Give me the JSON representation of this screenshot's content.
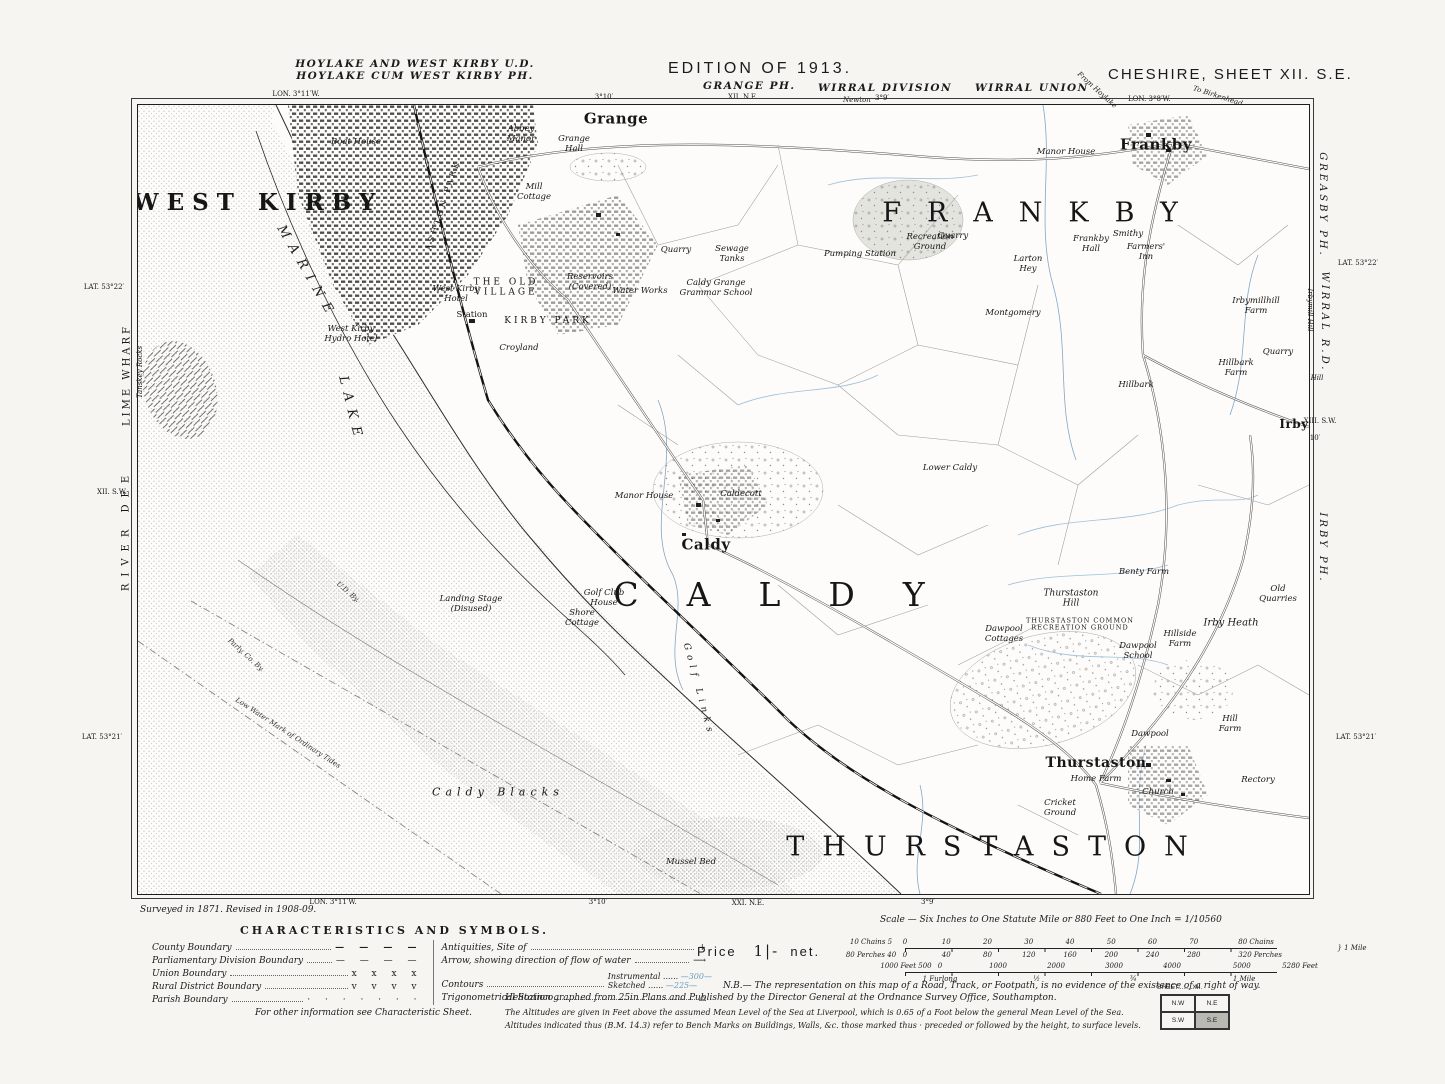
{
  "header": {
    "district_line1": "HOYLAKE AND WEST KIRBY U.D.",
    "district_line2": "HOYLAKE CUM WEST KIRBY PH.",
    "lon_left": "LON. 3°11′W.",
    "edition": "EDITION OF 1913.",
    "parish": "GRANGE PH.",
    "parish_sheet": "XII. N.E.",
    "division": "WIRRAL DIVISION",
    "division_sub": "Newton",
    "union": "WIRRAL UNION",
    "sheet_title": "CHESHIRE, SHEET XII. S.E.",
    "lon_right": "LON. 3°8′W.",
    "to_birkenhead": "To Birkenhead"
  },
  "margins": {
    "labels": [
      {
        "t": "LON. 3°11′W.",
        "x": 296,
        "y": 94,
        "cls": "mtiny"
      },
      {
        "t": "3°10′",
        "x": 604,
        "y": 97,
        "cls": "mtiny"
      },
      {
        "t": "3°9′",
        "x": 882,
        "y": 98,
        "cls": "mtiny"
      },
      {
        "t": "From Hoylake",
        "x": 1097,
        "y": 90,
        "cls": "mtiny-it",
        "rot": 42
      },
      {
        "t": "LAT. 53°22′",
        "x": 104,
        "y": 287,
        "cls": "mtiny"
      },
      {
        "t": "LIME WHARF",
        "x": 127,
        "y": 375,
        "cls": "mvert",
        "rot": -90
      },
      {
        "t": "Tanskey Rocks",
        "x": 140,
        "y": 372,
        "cls": "mtiny-it",
        "rot": -90
      },
      {
        "t": "RIVER DEE",
        "x": 126,
        "y": 530,
        "cls": "mvert",
        "rot": -90,
        "ls": 7
      },
      {
        "t": "XII. S.W.",
        "x": 112,
        "y": 492,
        "cls": "mtiny"
      },
      {
        "t": "LAT. 53°21′",
        "x": 102,
        "y": 737,
        "cls": "mtiny"
      },
      {
        "t": "GREASBY PH.",
        "x": 1322,
        "y": 205,
        "cls": "mvert-it",
        "rot": 90
      },
      {
        "t": "LAT. 53°22′",
        "x": 1358,
        "y": 263,
        "cls": "mtiny"
      },
      {
        "t": "Irbymill Hill",
        "x": 1310,
        "y": 310,
        "cls": "mtiny-it",
        "rot": 90
      },
      {
        "t": "WIRRAL R.D.",
        "x": 1324,
        "y": 322,
        "cls": "mvert-it",
        "rot": 90
      },
      {
        "t": "Hill",
        "x": 1317,
        "y": 378,
        "cls": "mtiny-it"
      },
      {
        "t": "XIII. S.W.",
        "x": 1320,
        "y": 421,
        "cls": "mtiny"
      },
      {
        "t": "10′",
        "x": 1315,
        "y": 438,
        "cls": "mtiny"
      },
      {
        "t": "IRBY PH.",
        "x": 1322,
        "y": 548,
        "cls": "mvert-it",
        "rot": 90
      },
      {
        "t": "LAT. 53°21′",
        "x": 1356,
        "y": 737,
        "cls": "mtiny"
      },
      {
        "t": "LON. 3°11′W.",
        "x": 333,
        "y": 902,
        "cls": "mtiny"
      },
      {
        "t": "3°10′",
        "x": 598,
        "y": 902,
        "cls": "mtiny"
      },
      {
        "t": "XXI. N.E.",
        "x": 748,
        "y": 903,
        "cls": "mtiny"
      },
      {
        "t": "3°9′",
        "x": 928,
        "y": 902,
        "cls": "mtiny"
      }
    ]
  },
  "map": {
    "labels": [
      {
        "t": "WEST KIRBY",
        "x": 120,
        "y": 98,
        "cls": "name-town"
      },
      {
        "t": "MARINE",
        "x": 168,
        "y": 168,
        "cls": "sea-med",
        "rot": 60,
        "ls": 8
      },
      {
        "t": "LAKE",
        "x": 212,
        "y": 305,
        "cls": "sea-med",
        "rot": 76,
        "ls": 8
      },
      {
        "t": "FRANKBY",
        "x": 905,
        "y": 108,
        "cls": "big",
        "fs": 27,
        "ls": 26
      },
      {
        "t": "Frankby",
        "x": 1018,
        "y": 40,
        "cls": "village"
      },
      {
        "t": "Grange",
        "x": 478,
        "y": 14,
        "cls": "village"
      },
      {
        "t": "Caldy",
        "x": 568,
        "y": 440,
        "cls": "village"
      },
      {
        "t": "CALDY",
        "x": 655,
        "y": 490,
        "cls": "big",
        "fs": 33,
        "ls": 48
      },
      {
        "t": "THURSTASTON",
        "x": 858,
        "y": 742,
        "cls": "big",
        "fs": 27,
        "ls": 18
      },
      {
        "t": "Thurstaston",
        "x": 958,
        "y": 658,
        "cls": "village",
        "fs": 14
      },
      {
        "t": "Irby",
        "x": 1156,
        "y": 320,
        "cls": "village",
        "fs": 12
      },
      {
        "t": "THE OLD\nVILLAGE",
        "x": 368,
        "y": 183,
        "cls": "subcaps"
      },
      {
        "t": "KIRBY PARK",
        "x": 410,
        "y": 216,
        "cls": "subcaps"
      },
      {
        "t": "ASHTON PARK",
        "x": 305,
        "y": 100,
        "cls": "subcaps",
        "rot": -72,
        "fs": 8
      },
      {
        "t": "Boat House",
        "x": 218,
        "y": 38,
        "cls": "sm"
      },
      {
        "t": "Abbey\nManor",
        "x": 383,
        "y": 30,
        "cls": "sm"
      },
      {
        "t": "Grange\nHall",
        "x": 436,
        "y": 40,
        "cls": "sm"
      },
      {
        "t": "Mill\nCottage",
        "x": 396,
        "y": 88,
        "cls": "sm"
      },
      {
        "t": "West Kirby\nHotel",
        "x": 318,
        "y": 190,
        "cls": "sm"
      },
      {
        "t": "Station",
        "x": 334,
        "y": 211,
        "cls": "smu"
      },
      {
        "t": "Reservoirs\n(Covered)",
        "x": 452,
        "y": 178,
        "cls": "sm"
      },
      {
        "t": "Water Works",
        "x": 502,
        "y": 187,
        "cls": "sm"
      },
      {
        "t": "Sewage\nTanks",
        "x": 594,
        "y": 150,
        "cls": "sm"
      },
      {
        "t": "Caldy Grange\nGrammar School",
        "x": 578,
        "y": 184,
        "cls": "sm"
      },
      {
        "t": "Quarry",
        "x": 538,
        "y": 146,
        "cls": "sm"
      },
      {
        "t": "Pumping Station",
        "x": 722,
        "y": 150,
        "cls": "sm"
      },
      {
        "t": "Recreation\nGround",
        "x": 792,
        "y": 138,
        "cls": "sm"
      },
      {
        "t": "Quarry",
        "x": 815,
        "y": 132,
        "cls": "sm"
      },
      {
        "t": "Manor House",
        "x": 928,
        "y": 48,
        "cls": "sm"
      },
      {
        "t": "Frankby\nHall",
        "x": 953,
        "y": 140,
        "cls": "sm"
      },
      {
        "t": "Smithy",
        "x": 990,
        "y": 130,
        "cls": "sm"
      },
      {
        "t": "Farmers'\nInn",
        "x": 1008,
        "y": 148,
        "cls": "sm"
      },
      {
        "t": "Larton\nHey",
        "x": 890,
        "y": 160,
        "cls": "sm"
      },
      {
        "t": "Montgomery",
        "x": 875,
        "y": 209,
        "cls": "sm"
      },
      {
        "t": "Hillbark",
        "x": 998,
        "y": 281,
        "cls": "sm"
      },
      {
        "t": "Hillbark\nFarm",
        "x": 1098,
        "y": 264,
        "cls": "sm"
      },
      {
        "t": "Irbymillhill\nFarm",
        "x": 1118,
        "y": 202,
        "cls": "sm"
      },
      {
        "t": "Quarry",
        "x": 1140,
        "y": 248,
        "cls": "sm"
      },
      {
        "t": "Lower Caldy",
        "x": 812,
        "y": 364,
        "cls": "sm"
      },
      {
        "t": "Manor House",
        "x": 506,
        "y": 392,
        "cls": "sm"
      },
      {
        "t": "Caldecott",
        "x": 603,
        "y": 390,
        "cls": "sm"
      },
      {
        "t": "Golf Club\nHouse",
        "x": 466,
        "y": 494,
        "cls": "sm"
      },
      {
        "t": "Shore\nCottage",
        "x": 444,
        "y": 514,
        "cls": "sm"
      },
      {
        "t": "Landing Stage\n(Disused)",
        "x": 333,
        "y": 500,
        "cls": "sm"
      },
      {
        "t": "Golf Links",
        "x": 560,
        "y": 585,
        "cls": "sm",
        "rot": 75,
        "ls": 5,
        "fs": 9
      },
      {
        "t": "Caldy Blacks",
        "x": 360,
        "y": 688,
        "cls": "sea-name"
      },
      {
        "t": "Mussel Bed",
        "x": 553,
        "y": 758,
        "cls": "sm"
      },
      {
        "t": "U.D. By.",
        "x": 210,
        "y": 487,
        "cls": "tinylbl",
        "rot": 40
      },
      {
        "t": "Parly. Co. By.",
        "x": 108,
        "y": 550,
        "cls": "tinylbl",
        "rot": 42
      },
      {
        "t": "Low Water Mark of Ordinary Tides",
        "x": 150,
        "y": 628,
        "cls": "tinylbl",
        "rot": 33
      },
      {
        "t": "West Kirby\nHydro Hotel",
        "x": 213,
        "y": 230,
        "cls": "sm"
      },
      {
        "t": "Croyland",
        "x": 381,
        "y": 244,
        "cls": "sm"
      },
      {
        "t": "Thurstaston\nHill",
        "x": 933,
        "y": 494,
        "cls": "sm",
        "fs": 9
      },
      {
        "t": "THURSTASTON COMMON\nRECREATION GROUND",
        "x": 942,
        "y": 520,
        "cls": "tinycaps"
      },
      {
        "t": "Benty Farm",
        "x": 1006,
        "y": 468,
        "cls": "sm"
      },
      {
        "t": "Irby Heath",
        "x": 1093,
        "y": 518,
        "cls": "sm",
        "fs": 10
      },
      {
        "t": "Old\nQuarries",
        "x": 1140,
        "y": 490,
        "cls": "sm"
      },
      {
        "t": "Dawpool\nCottages",
        "x": 866,
        "y": 530,
        "cls": "sm"
      },
      {
        "t": "Dawpool\nSchool",
        "x": 1000,
        "y": 547,
        "cls": "sm"
      },
      {
        "t": "Hillside\nFarm",
        "x": 1042,
        "y": 535,
        "cls": "sm"
      },
      {
        "t": "Dawpool",
        "x": 1012,
        "y": 630,
        "cls": "sm"
      },
      {
        "t": "Hill\nFarm",
        "x": 1092,
        "y": 620,
        "cls": "sm"
      },
      {
        "t": "Home Farm",
        "x": 958,
        "y": 675,
        "cls": "sm"
      },
      {
        "t": "Cricket\nGround",
        "x": 922,
        "y": 704,
        "cls": "sm"
      },
      {
        "t": "Church",
        "x": 1020,
        "y": 688,
        "cls": "sm"
      },
      {
        "t": "Rectory",
        "x": 1120,
        "y": 676,
        "cls": "sm"
      }
    ]
  },
  "footer": {
    "survey_note": "Surveyed in 1871.   Revised in 1908-09.",
    "characteristics_title": "CHARACTERISTICS AND SYMBOLS.",
    "characteristics_foot": "For other information see Characteristic Sheet.",
    "legend_left": [
      {
        "label": "County Boundary",
        "sym": "— — — —",
        "bold": true
      },
      {
        "label": "Parliamentary Division Boundary",
        "sym": "— — — —"
      },
      {
        "label": "Union Boundary",
        "sym": "x  x  x  x"
      },
      {
        "label": "Rural District Boundary",
        "sym": "v  v  v  v"
      },
      {
        "label": "Parish Boundary",
        "sym": "· · · · · · ·"
      }
    ],
    "legend_right": [
      {
        "label": "Antiquities, Site of",
        "sym": "+"
      },
      {
        "label": "Arrow, showing direction of flow of water",
        "sym": "⟶"
      },
      {
        "label": "Contours",
        "items": [
          {
            "n": "Instrumental",
            "v": "300"
          },
          {
            "n": "Sketched",
            "v": "225"
          }
        ]
      },
      {
        "label": "Trigonometrical Station",
        "sym": "△"
      }
    ],
    "price_label": "Price",
    "price_value": "1|-",
    "price_net": "net.",
    "scale_title": "Scale — Six Inches to One Statute Mile or 880 Feet to One Inch = 1/10560",
    "chains": {
      "caption": "10 Chains 5",
      "ticks": [
        "0",
        "10",
        "20",
        "30",
        "40",
        "50",
        "60",
        "70"
      ],
      "end": "80 Chains"
    },
    "perches": {
      "caption": "80 Perches 40",
      "ticks": [
        "0",
        "40",
        "80",
        "120",
        "160",
        "200",
        "240",
        "280"
      ],
      "end": "320 Perches"
    },
    "mile_brace": "1 Mile",
    "feet": {
      "caption": "1000 Feet  500",
      "ticks": [
        "0",
        "1000",
        "2000",
        "3000",
        "4000"
      ],
      "end": "5000",
      "total": "5280 Feet"
    },
    "furlongs": {
      "ticks": [
        "1 Furlong",
        "½",
        "¾"
      ],
      "end": "1 Mile"
    },
    "nb_note": "N.B.— The representation on this map of a Road, Track, or Footpath, is no evidence of the existence of a right of way.",
    "helio_note": "Heliozincographed from 25in Plans and Published by the Director General at the Ordnance Survey Office, Southampton.",
    "alt_note1": "The Altitudes are given in Feet above the assumed Mean Level of the Sea at Liverpool, which is 0.65 of a Foot below the general Mean Level of the Sea.",
    "alt_note2": "Altitudes indicated thus (B.M. 14.3) refer to Bench Marks on Buildings, Walls, &c. those marked thus · preceded or followed by the height, to surface levels.",
    "sheet_index_title": "SHEET........XII.",
    "sheet_cells": [
      "N.W",
      "N.E",
      "S.W",
      "S.E"
    ],
    "sheet_shaded": "S.E"
  }
}
